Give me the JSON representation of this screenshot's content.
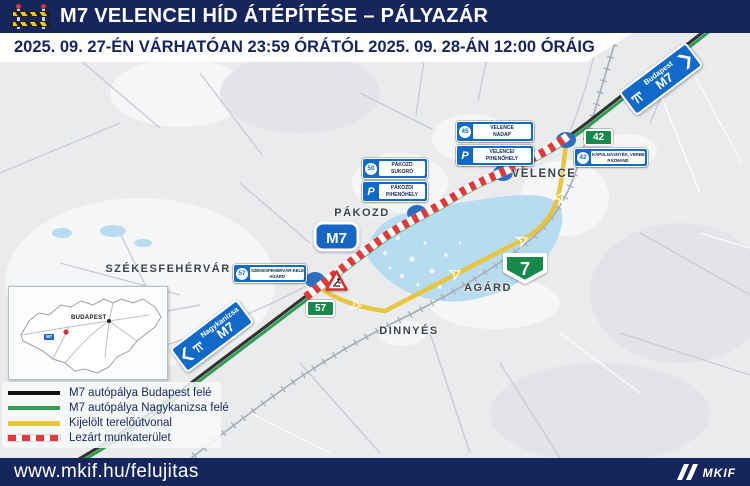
{
  "header": {
    "title": "M7 VELENCEI HÍD ÁTÉPÍTÉSE – PÁLYAZÁR",
    "subtitle": "2025. 09. 27-ÉN VÁRHATÓAN 23:59 ÓRÁTÓL 2025. 09. 28-ÁN 12:00 ÓRÁIG"
  },
  "map": {
    "town_labels": {
      "szekesfehervar": "SZÉKESFEHÉRVÁR",
      "pakozd": "PÁKOZD",
      "velence": "VELENCE",
      "agard": "AGÁRD",
      "dinnyes": "DINNYÉS"
    },
    "shields": {
      "m7": "M7",
      "road7": "7",
      "exit42": "42",
      "road57": "57"
    },
    "direction_signs": {
      "budapest": {
        "destination": "Budapest",
        "road": "M7"
      },
      "nagykanizsa": {
        "destination": "Nagykanizsa",
        "road": "M7"
      }
    },
    "service_signs": {
      "velence_nadap": {
        "icon": "45",
        "line1": "VELENCE",
        "line2": "NADAP"
      },
      "velencei_pihenohely": {
        "icon": "P",
        "line1": "VELENCEI",
        "line2": "PIHENŐHELY"
      },
      "pakozd_sukoro": {
        "icon": "50",
        "line1": "PÁKOZD",
        "line2": "SUKORÓ"
      },
      "pakozdi_pihenohely": {
        "icon": "P",
        "line1": "PÁKOZDI",
        "line2": "PIHENŐHELY"
      },
      "kapolnasnyek": {
        "icon": "42",
        "line1": "KÁPOLNÁSNYÉK, VEREB,",
        "line2": "PÁZMÁND"
      },
      "szekesfehervar_kelet": {
        "icon": "57",
        "line1": "SZÉKESFEHÉRVÁR-KELET",
        "line2": "AGÁRD"
      }
    },
    "inset": {
      "city": "BUDAPEST",
      "road_tag": "M7"
    }
  },
  "legend": {
    "items": [
      {
        "swatch": "black-line",
        "label": "M7 autópálya Budapest felé"
      },
      {
        "swatch": "green-line",
        "label": "M7 autópálya Nagykanizsa felé"
      },
      {
        "swatch": "yellow-line",
        "label": "Kijelölt terelőútvonal"
      },
      {
        "swatch": "red-dashed-line",
        "label": "Lezárt munkaterület"
      }
    ]
  },
  "footer": {
    "url": "www.mkif.hu/felujitas",
    "logo": "MKIF"
  },
  "colors": {
    "navy": "#16265C",
    "motorway_black": "#333333",
    "motorway_green": "#2D9E52",
    "detour_yellow": "#E7C53F",
    "closed_red": "#E23A3A",
    "sign_blue": "#1169C9",
    "shield_green": "#178A4B",
    "lake_blue": "#B8DCEF"
  }
}
